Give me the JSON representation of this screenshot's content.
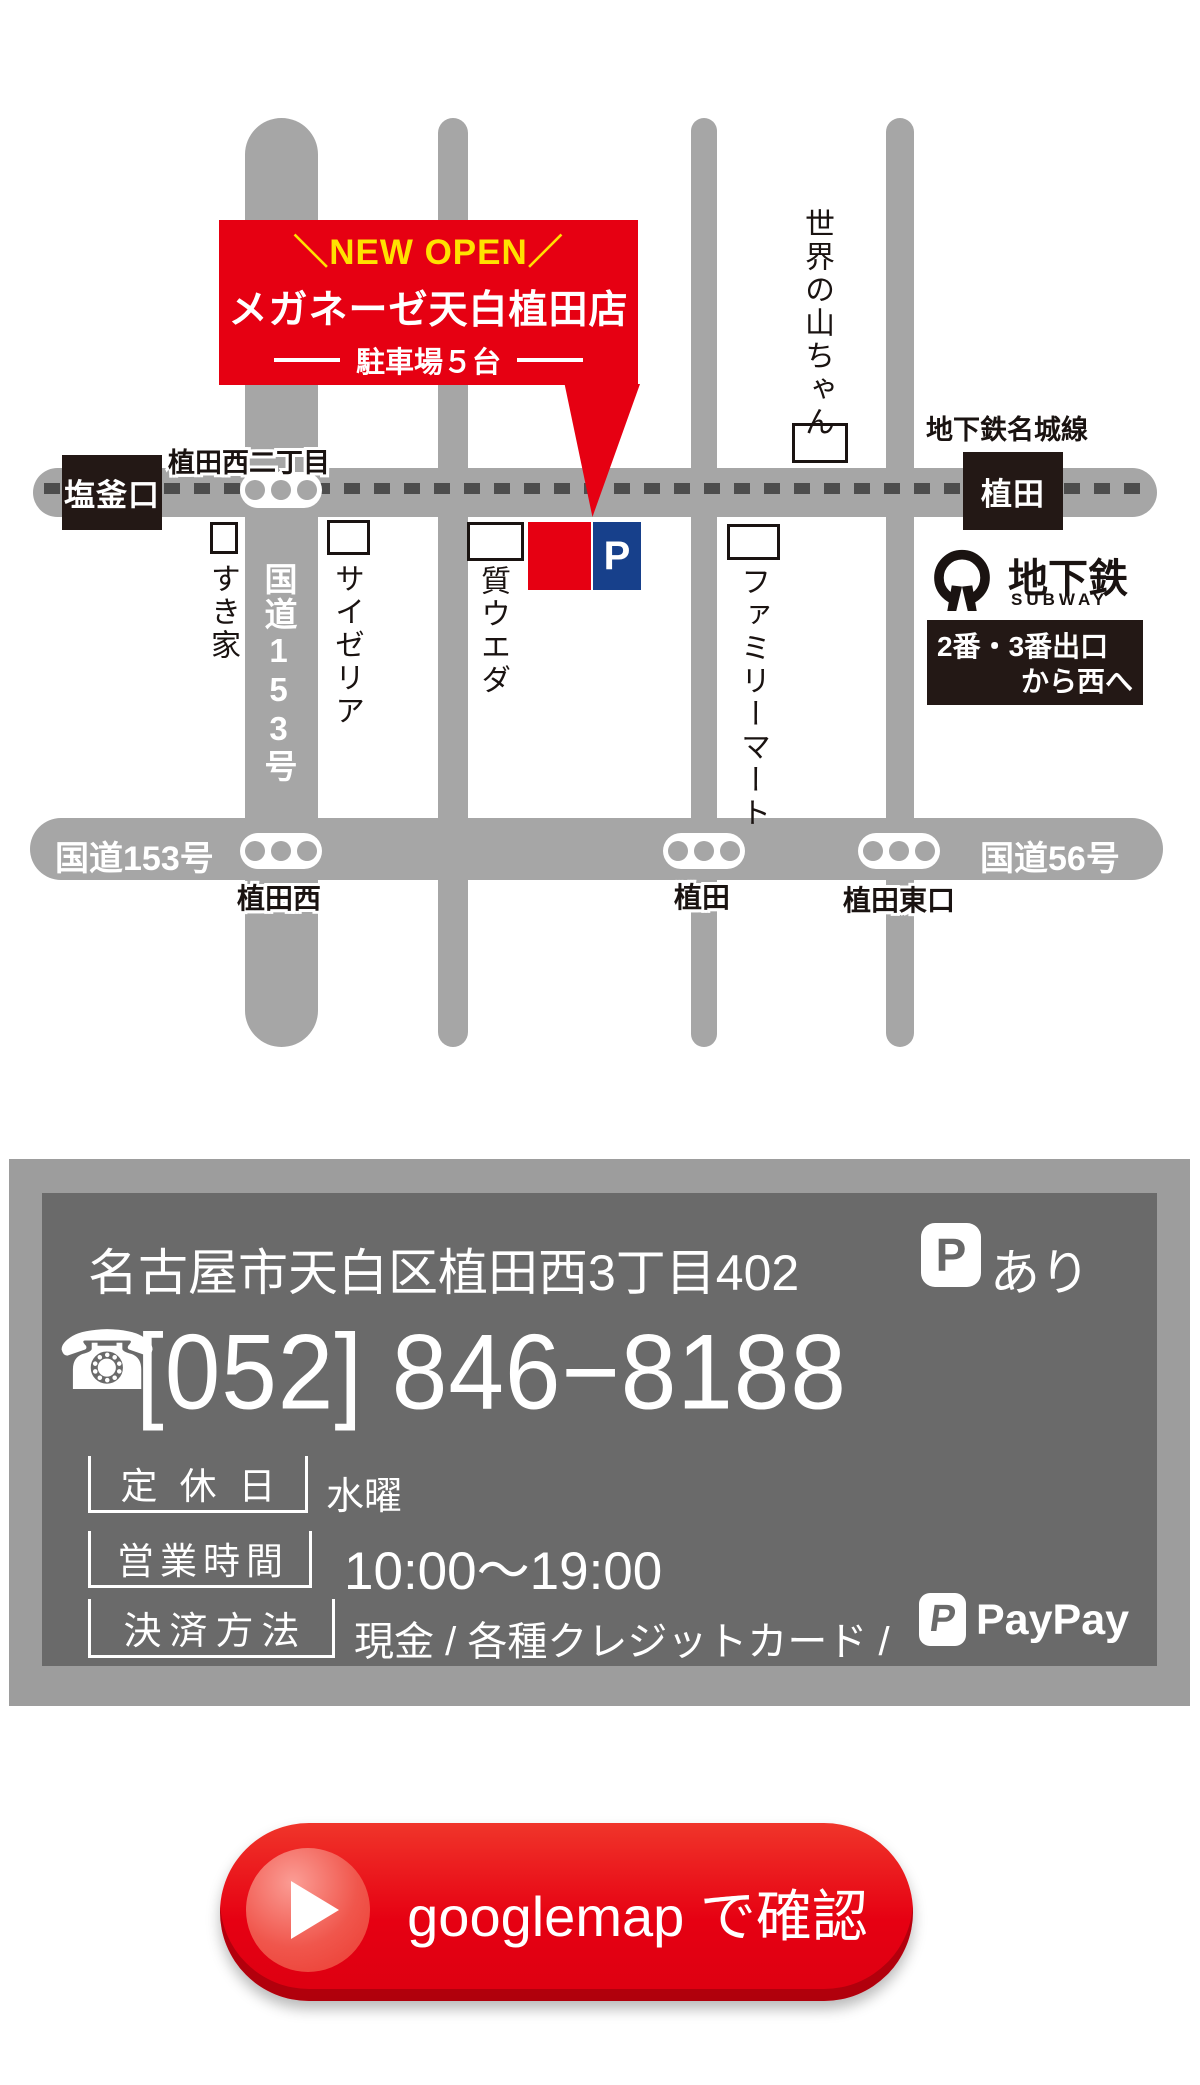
{
  "colors": {
    "accent_red": "#e60012",
    "banner_yellow": "#ffe100",
    "parking_blue": "#17408b",
    "map_road_gray": "#a6a6a6",
    "print_black": "#231815",
    "panel_outer_gray": "#9d9d9d",
    "panel_inner_gray": "#6a6a6a"
  },
  "map": {
    "banner": {
      "new_open": "＼NEW OPEN／",
      "store_name": "メガネーゼ天白植田店",
      "parking": "駐車場５台"
    },
    "stations": {
      "left": "塩釜口",
      "right": "植田"
    },
    "subway_line_label": "地下鉄名城線",
    "subway_logo": {
      "jp": "地下鉄",
      "en": "SUBWAY"
    },
    "exit_info": {
      "line1": "2番・3番出口",
      "line2": "から西へ"
    },
    "road_labels": {
      "route153_vertical": "国道153号",
      "route153_bottom": "国道153号",
      "route56": "国道56号"
    },
    "intersections": {
      "top": "植田西二丁目",
      "bottom_left": "植田西",
      "bottom_center": "植田",
      "bottom_right": "植田東口"
    },
    "landmarks": {
      "sukiya": "すき家",
      "saizeriya": "サイゼリア",
      "shichi_ueda": "質ウエダ",
      "familymart": "ファミリーマート",
      "yamachan": "世界の山ちゃん"
    },
    "parking_mark": "P"
  },
  "info": {
    "address": "名古屋市天白区植田西3丁目402",
    "parking_icon": "P",
    "parking_note": "あり",
    "phone_icon": "☎",
    "phone": "[052] 846−8188",
    "closed_label": "定休日",
    "closed_value": "水曜",
    "hours_label": "営業時間",
    "hours_value": "10:00〜19:00",
    "payment_label": "決済方法",
    "payment_value": "現金 / 各種クレジットカード /",
    "paypay_icon_letter": "P",
    "paypay_text": "PayPay"
  },
  "button": {
    "label": "googlemap で確認"
  }
}
